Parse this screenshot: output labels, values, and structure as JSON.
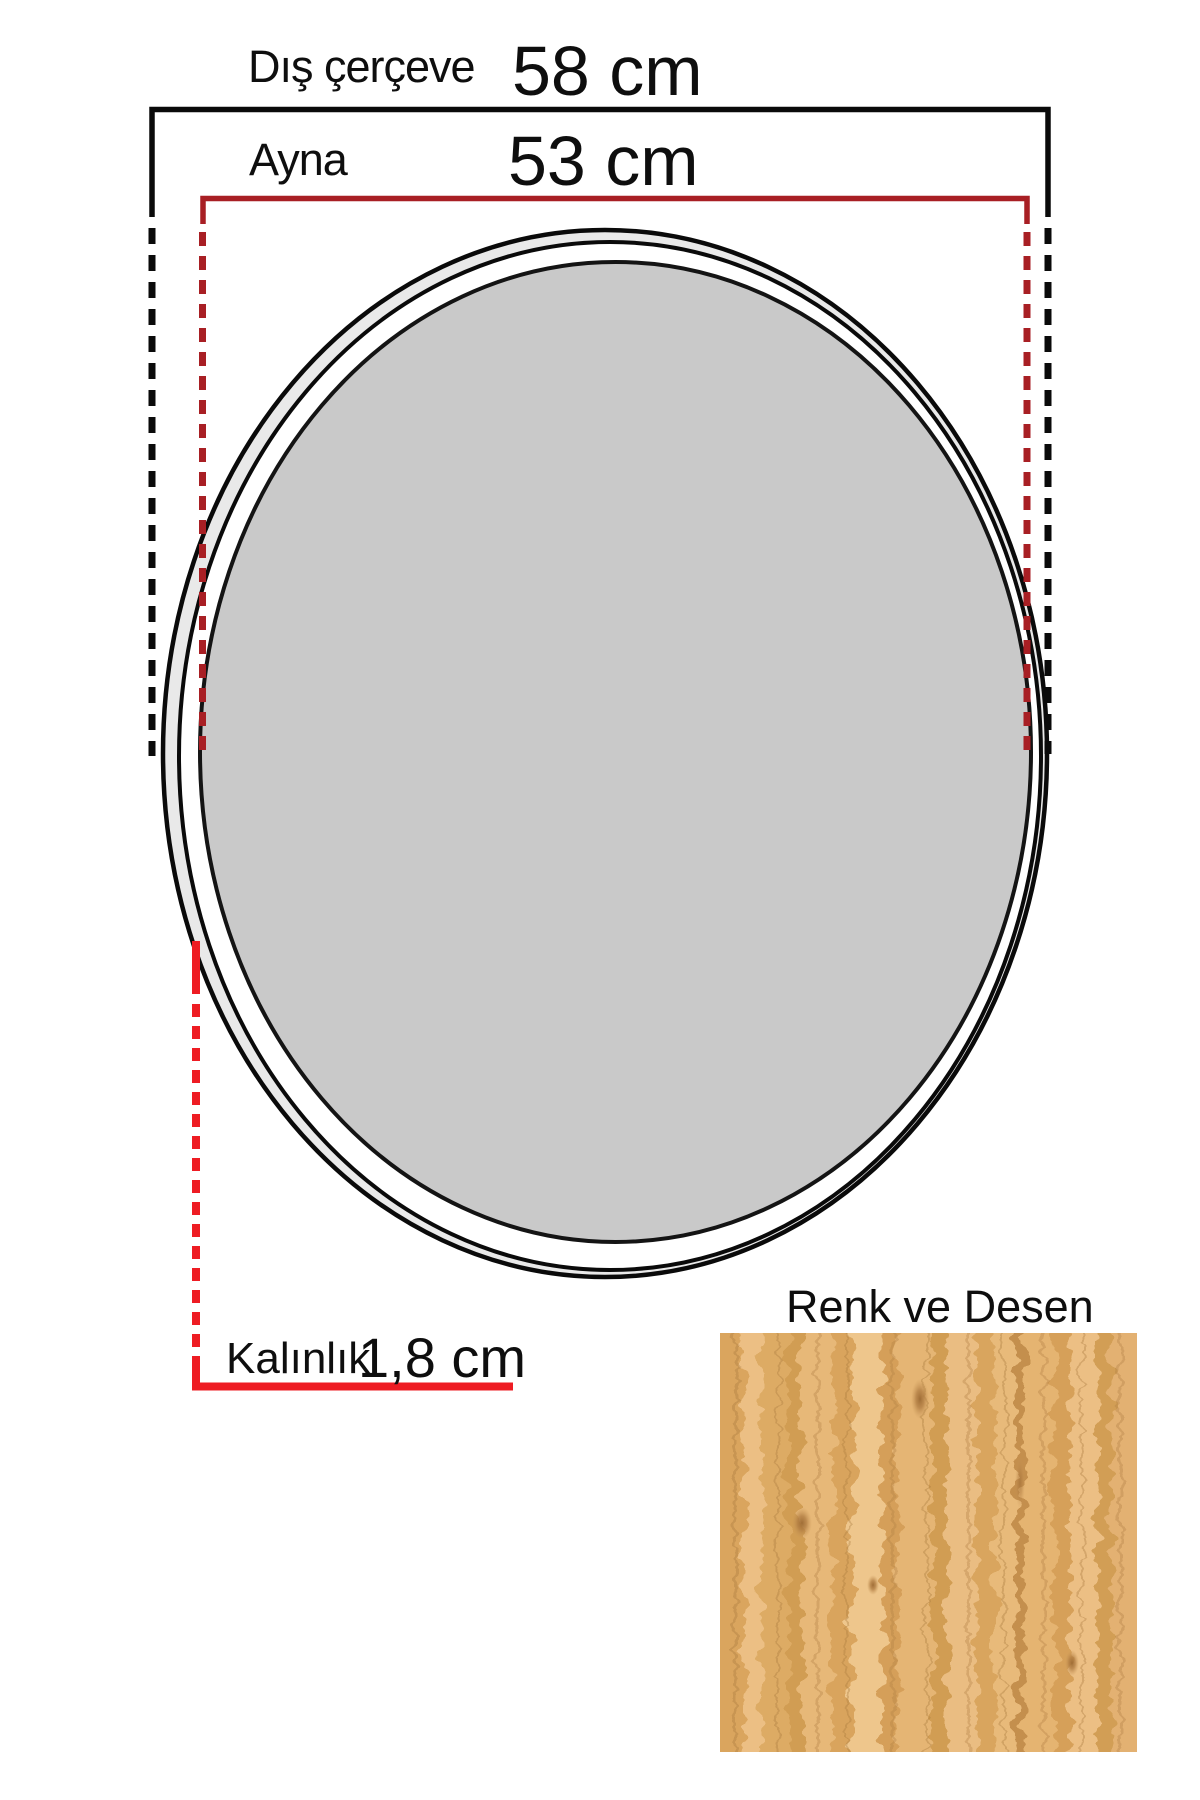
{
  "diagram": {
    "title_context": "mirror-dimension-diagram",
    "outer_frame": {
      "label": "Dış çerçeve",
      "value": "58 cm"
    },
    "mirror": {
      "label": "Ayna",
      "value": "53 cm"
    },
    "thickness": {
      "label": "Kalınlık",
      "value": "1,8 cm"
    },
    "swatch": {
      "label": "Renk ve Desen"
    }
  },
  "colors": {
    "outer_dimension_line": "#0a0a0a",
    "mirror_dimension_line": "#a81f24",
    "thickness_line": "#ee1c23",
    "mirror_fill": "#c9c9c9",
    "frame_band_fill": "#e9e9e9",
    "wood_base": "#e3b170",
    "background": "#ffffff"
  }
}
